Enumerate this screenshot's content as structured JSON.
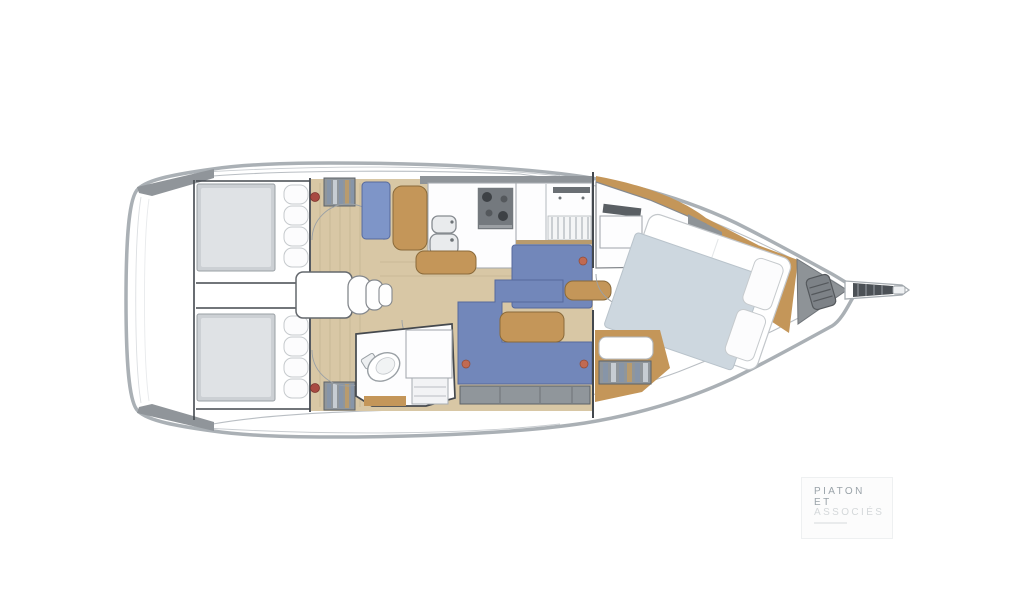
{
  "logo": {
    "line1": "PIATON",
    "line2": "ET",
    "line3": "ASSOCIÉS"
  },
  "colors": {
    "page_bg": "#ffffff",
    "hull_stroke": "#aab0b5",
    "hull_inner": "#b9bec3",
    "gunwale": "#90959a",
    "dark_line": "#43484e",
    "floor_wood": "#d8c7a5",
    "plank_line": "#c6b492",
    "furniture_wood": "#c49659",
    "wood_edge": "#8a6a3a",
    "bed_gray": "#ccd0d4",
    "bed_gray_light": "#dfe2e5",
    "settee_blue": "#7287ba",
    "settee_edge": "#56699c",
    "nav_seat_blue": "#7e95c8",
    "panel_gray": "#8e9397",
    "stove_gray": "#74797e",
    "duvet_gray": "#cdd7df",
    "locker_gray": "#90969b",
    "accent_red": "#a84a42",
    "accent_orange": "#c06a52",
    "logo_text": "#9aa3a9",
    "logo_text_light": "#d4d8da"
  },
  "diagram": {
    "type": "yacht-floor-plan",
    "orientation": "bow-right",
    "areas": [
      "swim-platform",
      "aft-cabin-top",
      "aft-cabin-bottom",
      "engine-compartment",
      "companionway-steps",
      "galley",
      "nav-station",
      "saloon-settee-top",
      "saloon-settee-bottom",
      "saloon-table",
      "aft-head",
      "forward-head",
      "owner-cabin",
      "anchor-locker",
      "bowsprit"
    ]
  }
}
